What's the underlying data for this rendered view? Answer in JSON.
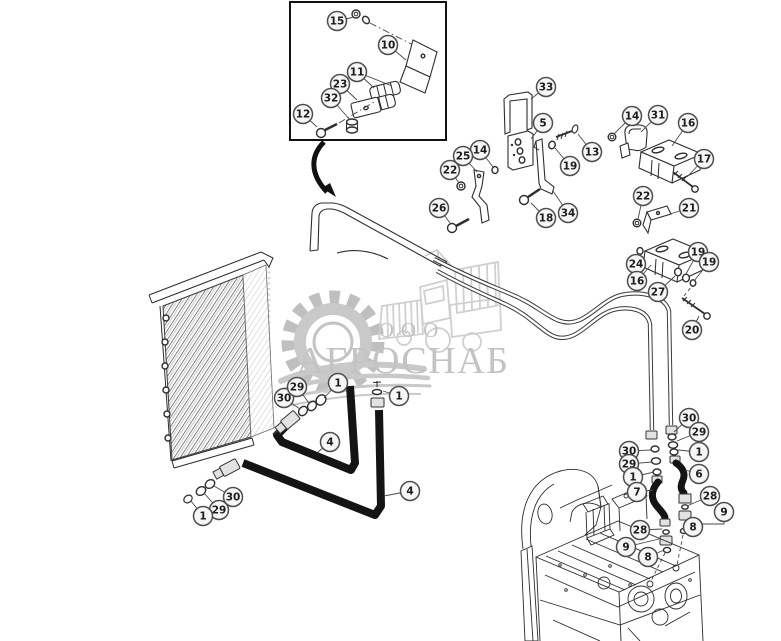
{
  "watermark": {
    "company_type": "ООО",
    "company_name": "АГРОСНАБ"
  },
  "colors": {
    "background": "#ffffff",
    "line": "#2a2a2a",
    "watermark": "#c3c3c3",
    "hose": "#141414"
  },
  "callouts": [
    {
      "label": "15",
      "x": 337,
      "y": 21,
      "leaders": [
        [
          [
            354,
            17
          ]
        ]
      ]
    },
    {
      "label": "10",
      "x": 388,
      "y": 45,
      "leaders": [
        [
          [
            406,
            60
          ]
        ]
      ]
    },
    {
      "label": "11",
      "x": 357,
      "y": 72,
      "leaders": [
        [
          [
            374,
            88
          ]
        ],
        [
          [
            392,
            86
          ]
        ]
      ]
    },
    {
      "label": "23",
      "x": 340,
      "y": 84,
      "leaders": [
        [
          [
            357,
            100
          ]
        ]
      ]
    },
    {
      "label": "32",
      "x": 331,
      "y": 98,
      "leaders": [
        [
          [
            350,
            120
          ]
        ]
      ]
    },
    {
      "label": "12",
      "x": 303,
      "y": 114,
      "leaders": [
        [
          [
            317,
            127
          ]
        ]
      ]
    },
    {
      "label": "33",
      "x": 546,
      "y": 87,
      "leaders": [
        [
          [
            531,
            99
          ]
        ]
      ]
    },
    {
      "label": "5",
      "x": 543,
      "y": 123,
      "leaders": [
        [
          [
            531,
            139
          ]
        ]
      ]
    },
    {
      "label": "14",
      "x": 480,
      "y": 150,
      "leaders": [
        [
          [
            493,
            167
          ]
        ]
      ]
    },
    {
      "label": "25",
      "x": 463,
      "y": 156,
      "leaders": [
        [
          [
            477,
            172
          ]
        ]
      ]
    },
    {
      "label": "22",
      "x": 450,
      "y": 170,
      "leaders": [
        [
          [
            459,
            183
          ]
        ]
      ]
    },
    {
      "label": "26",
      "x": 439,
      "y": 208,
      "leaders": [
        [
          [
            450,
            223
          ]
        ]
      ]
    },
    {
      "label": "18",
      "x": 546,
      "y": 218,
      "leaders": [
        [
          [
            531,
            203
          ]
        ]
      ]
    },
    {
      "label": "34",
      "x": 568,
      "y": 213,
      "leaders": [
        [
          [
            553,
            191
          ]
        ]
      ]
    },
    {
      "label": "19",
      "x": 570,
      "y": 166,
      "leaders": [
        [
          [
            555,
            148
          ]
        ]
      ]
    },
    {
      "label": "13",
      "x": 592,
      "y": 152,
      "leaders": [
        [
          [
            578,
            134
          ]
        ]
      ]
    },
    {
      "label": "14",
      "x": 632,
      "y": 116,
      "leaders": [
        [
          [
            614,
            134
          ]
        ]
      ]
    },
    {
      "label": "31",
      "x": 658,
      "y": 115,
      "leaders": [
        [
          [
            641,
            132
          ]
        ]
      ]
    },
    {
      "label": "16",
      "x": 688,
      "y": 123,
      "leaders": [
        [
          [
            672,
            146
          ]
        ]
      ]
    },
    {
      "label": "17",
      "x": 704,
      "y": 159,
      "leaders": [
        [
          [
            687,
            177
          ]
        ]
      ]
    },
    {
      "label": "22",
      "x": 643,
      "y": 196,
      "leaders": [
        [
          [
            638,
            219
          ]
        ]
      ]
    },
    {
      "label": "21",
      "x": 689,
      "y": 208,
      "leaders": [
        [
          [
            670,
            214
          ]
        ]
      ]
    },
    {
      "label": "24",
      "x": 636,
      "y": 264,
      "leaders": [
        [
          [
            640,
            253
          ]
        ]
      ]
    },
    {
      "label": "16",
      "x": 637,
      "y": 281,
      "leaders": [
        [
          [
            651,
            265
          ]
        ]
      ]
    },
    {
      "label": "27",
      "x": 658,
      "y": 292,
      "leaders": [
        [
          [
            675,
            276
          ]
        ]
      ]
    },
    {
      "label": "19",
      "x": 698,
      "y": 252,
      "leaders": [
        [
          [
            686,
            274
          ]
        ]
      ]
    },
    {
      "label": "19",
      "x": 709,
      "y": 262,
      "leaders": [
        [
          [
            694,
            281
          ]
        ]
      ]
    },
    {
      "label": "20",
      "x": 692,
      "y": 330,
      "leaders": [
        [
          [
            699,
            316
          ]
        ]
      ]
    },
    {
      "label": "30",
      "x": 284,
      "y": 398,
      "leaders": [
        [
          [
            300,
            409
          ]
        ]
      ]
    },
    {
      "label": "29",
      "x": 297,
      "y": 387,
      "leaders": [
        [
          [
            309,
            403
          ]
        ]
      ]
    },
    {
      "label": "1",
      "x": 338,
      "y": 383,
      "leaders": [
        [
          [
            324,
            398
          ]
        ]
      ]
    },
    {
      "label": "1",
      "x": 399,
      "y": 396,
      "leaders": [
        [
          [
            383,
            391
          ]
        ]
      ]
    },
    {
      "label": "4",
      "x": 330,
      "y": 442,
      "leaders": [
        [
          [
            318,
            452
          ]
        ]
      ]
    },
    {
      "label": "4",
      "x": 410,
      "y": 491,
      "leaders": [
        [
          [
            384,
            496
          ]
        ]
      ]
    },
    {
      "label": "30",
      "x": 233,
      "y": 497,
      "leaders": [
        [
          [
            214,
            486
          ]
        ]
      ]
    },
    {
      "label": "29",
      "x": 219,
      "y": 510,
      "leaders": [
        [
          [
            204,
            493
          ]
        ]
      ]
    },
    {
      "label": "1",
      "x": 203,
      "y": 516,
      "leaders": [
        [
          [
            191,
            501
          ]
        ]
      ]
    },
    {
      "label": "30",
      "x": 689,
      "y": 418,
      "leaders": [
        [
          [
            674,
            432
          ]
        ]
      ]
    },
    {
      "label": "29",
      "x": 699,
      "y": 432,
      "leaders": [
        [
          [
            677,
            441
          ]
        ]
      ]
    },
    {
      "label": "1",
      "x": 699,
      "y": 452,
      "leaders": [
        [
          [
            678,
            450
          ]
        ]
      ]
    },
    {
      "label": "30",
      "x": 629,
      "y": 451,
      "leaders": [
        [
          [
            651,
            450
          ]
        ]
      ]
    },
    {
      "label": "29",
      "x": 629,
      "y": 464,
      "leaders": [
        [
          [
            652,
            462
          ]
        ]
      ]
    },
    {
      "label": "1",
      "x": 633,
      "y": 477,
      "leaders": [
        [
          [
            654,
            472
          ]
        ]
      ]
    },
    {
      "label": "6",
      "x": 699,
      "y": 474,
      "leaders": [
        [
          [
            685,
            470
          ]
        ]
      ]
    },
    {
      "label": "7",
      "x": 637,
      "y": 492,
      "leaders": [
        [
          [
            653,
            490
          ]
        ]
      ]
    },
    {
      "label": "28",
      "x": 710,
      "y": 496,
      "leaders": [
        [
          [
            687,
            506
          ]
        ]
      ]
    },
    {
      "label": "9",
      "x": 724,
      "y": 512,
      "leaders": [
        [
          [
            724,
            524
          ],
          [
            699,
            524
          ]
        ]
      ]
    },
    {
      "label": "8",
      "x": 693,
      "y": 527,
      "leaders": [
        [
          [
            686,
            531
          ]
        ]
      ]
    },
    {
      "label": "28",
      "x": 640,
      "y": 530,
      "leaders": [
        [
          [
            662,
            529
          ]
        ]
      ]
    },
    {
      "label": "9",
      "x": 626,
      "y": 547,
      "leaders": [
        [
          [
            659,
            539
          ]
        ]
      ]
    },
    {
      "label": "8",
      "x": 648,
      "y": 557,
      "leaders": [
        [
          [
            664,
            550
          ]
        ]
      ]
    }
  ]
}
